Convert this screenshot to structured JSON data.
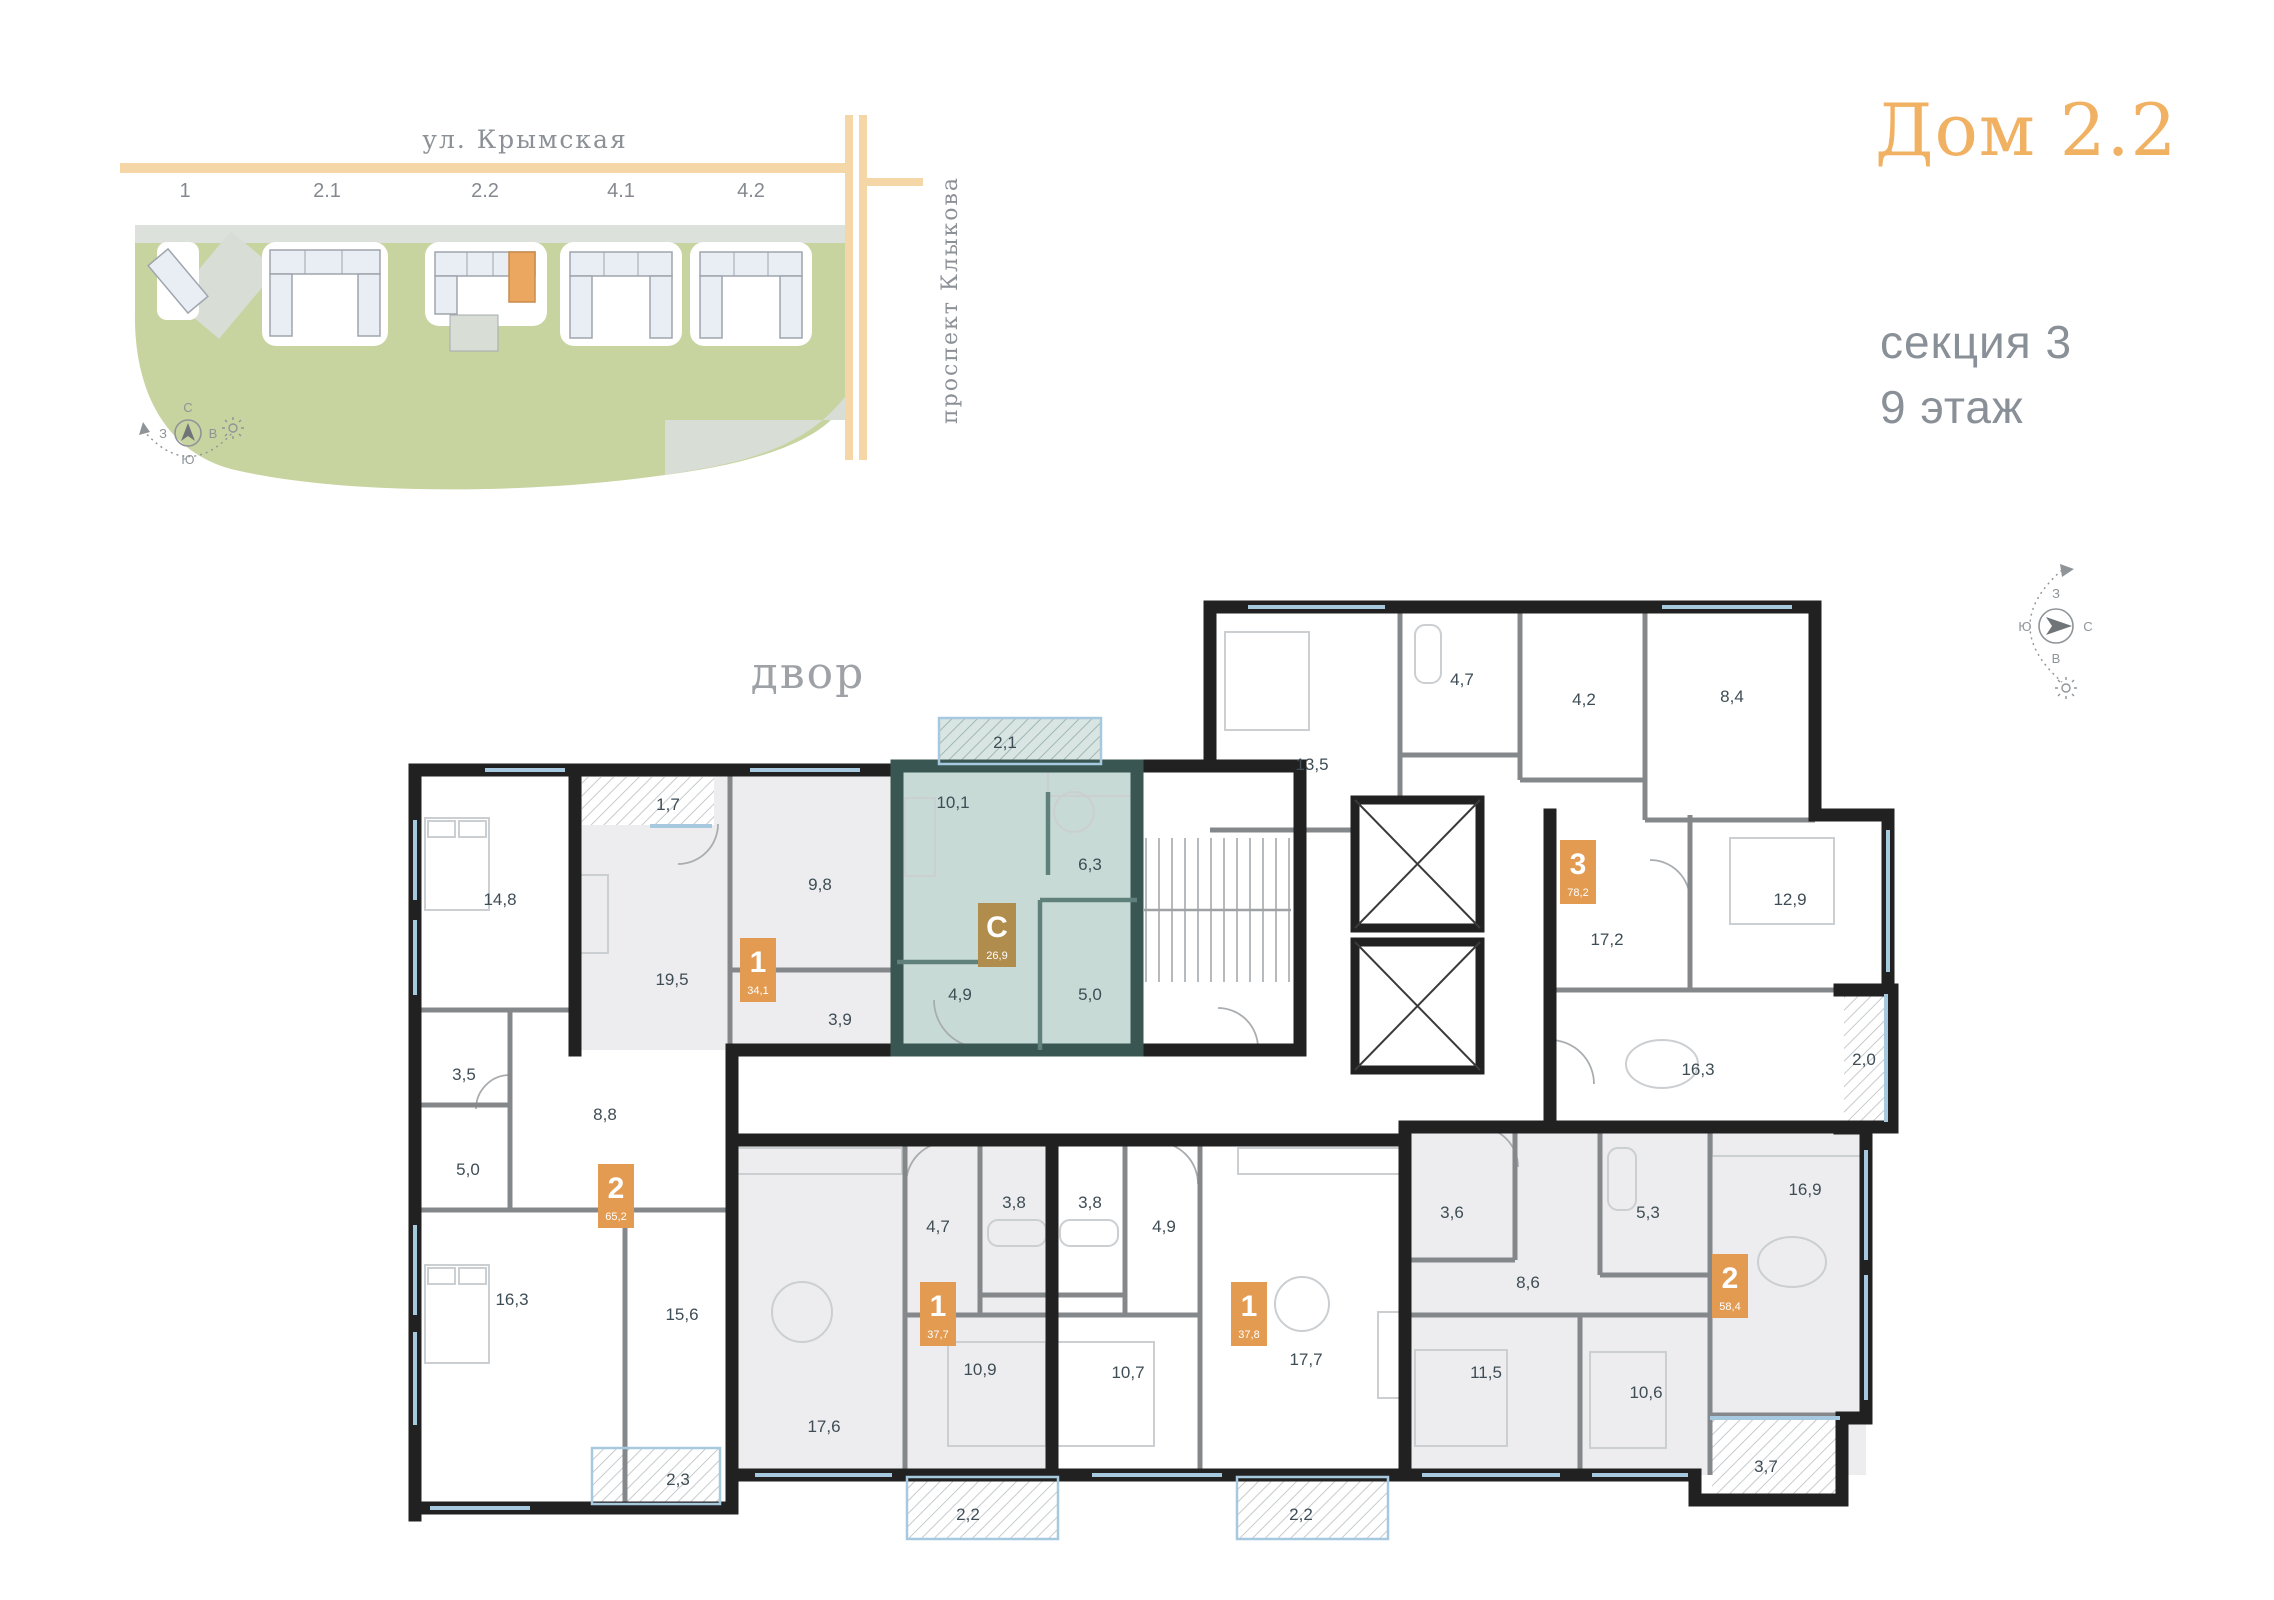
{
  "header": {
    "title": "Дом 2.2",
    "section": "секция 3",
    "floor": "9 этаж"
  },
  "site_map": {
    "street_top": "ул. Крымская",
    "street_right": "проспект Клыкова",
    "building_labels": [
      "1",
      "2.1",
      "2.2",
      "4.1",
      "4.2"
    ],
    "highlighted_building": "2.2",
    "compass": {
      "n": "С",
      "w": "З",
      "e": "В",
      "s": "Ю"
    }
  },
  "plan": {
    "courtyard": "двор",
    "badges": [
      {
        "type": "1",
        "area": "34,1"
      },
      {
        "type": "2",
        "area": "65,2"
      },
      {
        "type": "С",
        "area": "26,9"
      },
      {
        "type": "3",
        "area": "78,2"
      },
      {
        "type": "1",
        "area": "37,7"
      },
      {
        "type": "1",
        "area": "37,8"
      },
      {
        "type": "2",
        "area": "58,4"
      }
    ],
    "room_labels": [
      "1,7",
      "14,8",
      "9,8",
      "19,5",
      "3,9",
      "3,5",
      "5,0",
      "8,8",
      "16,3",
      "15,6",
      "2,3",
      "2,1",
      "10,1",
      "6,3",
      "4,9",
      "5,0",
      "13,5",
      "4,7",
      "4,2",
      "8,4",
      "12,9",
      "17,2",
      "16,3",
      "2,0",
      "4,7",
      "3,8",
      "10,9",
      "17,6",
      "2,2",
      "3,8",
      "4,9",
      "10,7",
      "17,7",
      "2,2",
      "3,6",
      "5,3",
      "8,6",
      "11,5",
      "10,6",
      "16,9",
      "3,7"
    ]
  },
  "colors": {
    "accent": "#E29B51",
    "studio_badge": "#B08C4D",
    "studio_wall": "#3A5652",
    "studio_fill": "#C7DAD6",
    "title": "#F0B163",
    "road": "#F5D7A7",
    "green": "#C7D4A0",
    "building": "#E9EDF4",
    "highlight_unit": "#EBA660"
  }
}
